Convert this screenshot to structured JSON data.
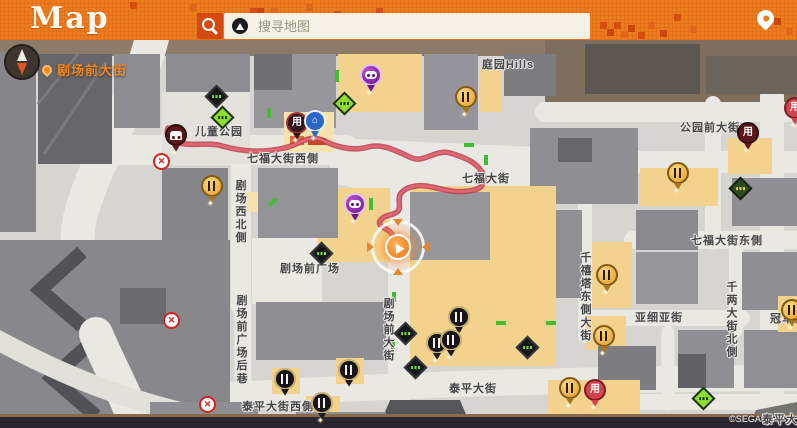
{
  "header": {
    "title": "Map",
    "search_placeholder": "搜寻地图",
    "accent_color": "#ee7c1d",
    "search_button_color": "#d24a10"
  },
  "hud": {
    "current_street": "剧场前大街"
  },
  "map": {
    "copyright": "©SEGA",
    "route_color": "#d44f5e",
    "building_color": "#8f8f93",
    "shop_building_color": "#f2d28d",
    "labels": [
      {
        "text": "儿童公园",
        "x": 219,
        "y": 131
      },
      {
        "text": "七福大街西側",
        "x": 283,
        "y": 158
      },
      {
        "text": "七福大街",
        "x": 486,
        "y": 178
      },
      {
        "text": "庭园Hills",
        "x": 508,
        "y": 64
      },
      {
        "text": "公园前大街",
        "x": 710,
        "y": 127
      },
      {
        "text": "七福大街东側",
        "x": 727,
        "y": 240
      },
      {
        "text": "亚细亚街",
        "x": 659,
        "y": 317
      },
      {
        "text": "泰平大街",
        "x": 473,
        "y": 388
      },
      {
        "text": "泰平大街西側",
        "x": 278,
        "y": 406
      },
      {
        "text": "剧场前广场",
        "x": 310,
        "y": 268
      },
      {
        "text": "冠军街",
        "x": 788,
        "y": 318
      },
      {
        "text": "泰平大",
        "x": 780,
        "y": 419
      },
      {
        "text": "剧场西北側",
        "x": 240,
        "y": 212,
        "vertical": true
      },
      {
        "text": "剧场前广场后巷",
        "x": 241,
        "y": 340,
        "vertical": true
      },
      {
        "text": "剧场前大街",
        "x": 388,
        "y": 330,
        "vertical": true
      },
      {
        "text": "千禧塔东側大街",
        "x": 585,
        "y": 297,
        "vertical": true
      },
      {
        "text": "千两大街北側",
        "x": 731,
        "y": 320,
        "vertical": true
      }
    ],
    "pins": [
      {
        "name": "restaurant-pin",
        "variant": "gold",
        "glyph": "fork",
        "x": 212,
        "y": 186
      },
      {
        "name": "restaurant-pin",
        "variant": "gold",
        "glyph": "fork",
        "x": 466,
        "y": 97
      },
      {
        "name": "restaurant-pin",
        "variant": "gold",
        "glyph": "fork",
        "x": 678,
        "y": 173
      },
      {
        "name": "restaurant-pin",
        "variant": "gold",
        "glyph": "fork",
        "x": 607,
        "y": 275
      },
      {
        "name": "restaurant-pin",
        "variant": "gold",
        "glyph": "fork",
        "x": 604,
        "y": 336
      },
      {
        "name": "restaurant-pin",
        "variant": "gold",
        "glyph": "fork",
        "x": 570,
        "y": 388
      },
      {
        "name": "restaurant-pin",
        "variant": "gold",
        "glyph": "fork",
        "x": 792,
        "y": 310
      },
      {
        "name": "restaurant-pin-dark",
        "variant": "black",
        "glyph": "fork",
        "x": 459,
        "y": 317
      },
      {
        "name": "restaurant-pin-dark",
        "variant": "black",
        "glyph": "fork",
        "x": 437,
        "y": 343
      },
      {
        "name": "restaurant-pin-dark",
        "variant": "black",
        "glyph": "fork",
        "x": 451,
        "y": 340
      },
      {
        "name": "restaurant-pin-dark",
        "variant": "black",
        "glyph": "fork",
        "x": 285,
        "y": 379
      },
      {
        "name": "restaurant-pin-dark",
        "variant": "black",
        "glyph": "fork",
        "x": 349,
        "y": 370
      },
      {
        "name": "restaurant-pin-dark",
        "variant": "black",
        "glyph": "fork",
        "x": 322,
        "y": 403
      },
      {
        "name": "shop-pin",
        "variant": "darkred",
        "glyph": "用",
        "x": 297,
        "y": 123
      },
      {
        "name": "shop-pin",
        "variant": "maroon",
        "glyph": "用",
        "x": 748,
        "y": 133
      },
      {
        "name": "shop-pin",
        "variant": "red",
        "glyph": "用",
        "x": 595,
        "y": 390
      },
      {
        "name": "shop-pin",
        "variant": "red",
        "glyph": "用",
        "x": 795,
        "y": 108
      },
      {
        "name": "facility-pin",
        "variant": "blue",
        "glyph": "⌂",
        "x": 315,
        "y": 121
      },
      {
        "name": "minigame-pin",
        "variant": "purple",
        "glyph": "pad",
        "x": 371,
        "y": 75
      },
      {
        "name": "minigame-pin",
        "variant": "purple",
        "glyph": "pad",
        "x": 355,
        "y": 204
      },
      {
        "name": "taxi-pin",
        "variant": "maroon",
        "glyph": "car",
        "x": 176,
        "y": 135
      }
    ],
    "signs": [
      {
        "variant": "green",
        "x": 222,
        "y": 117
      },
      {
        "variant": "green",
        "x": 344,
        "y": 103
      },
      {
        "variant": "green",
        "x": 703,
        "y": 398
      },
      {
        "variant": "black",
        "x": 216,
        "y": 96
      },
      {
        "variant": "black",
        "x": 321,
        "y": 253
      },
      {
        "variant": "black",
        "x": 405,
        "y": 333
      },
      {
        "variant": "black",
        "x": 415,
        "y": 367
      },
      {
        "variant": "black",
        "x": 527,
        "y": 347
      },
      {
        "variant": "darkgreen",
        "x": 740,
        "y": 188
      }
    ],
    "no_entry": [
      {
        "x": 161,
        "y": 161
      },
      {
        "x": 171,
        "y": 320
      },
      {
        "x": 207,
        "y": 404
      }
    ],
    "player": {
      "x": 398,
      "y": 247
    }
  }
}
